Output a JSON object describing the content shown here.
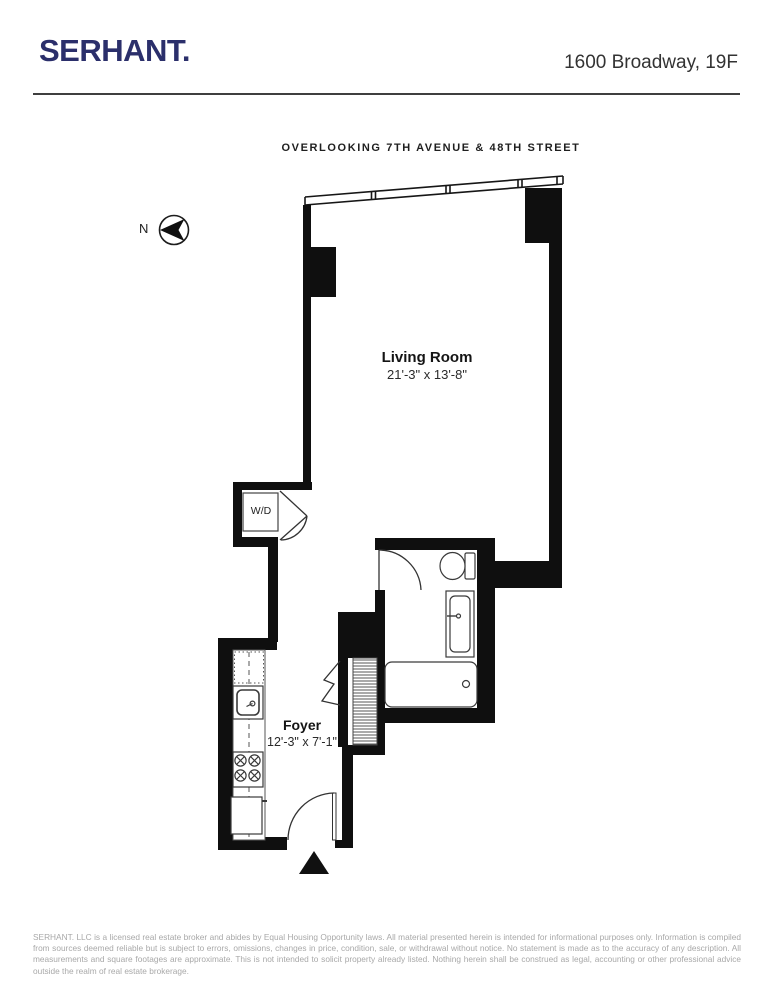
{
  "header": {
    "brand": "SERHANT.",
    "address": "1600 Broadway, 19F"
  },
  "plan": {
    "orientation_note": "OVERLOOKING 7TH AVENUE & 48TH STREET",
    "compass_label": "N",
    "rooms": [
      {
        "name": "Living Room",
        "dimensions": "21'-3\" x 13'-8\""
      },
      {
        "name": "Foyer",
        "dimensions": "12'-3\" x 7'-1\""
      }
    ],
    "fixtures": {
      "washer_dryer": "W/D"
    }
  },
  "footer": {
    "disclaimer": "SERHANT. LLC is a licensed real estate broker and abides by Equal Housing Opportunity laws. All material presented herein is intended for informational purposes only. Information is compiled from sources deemed reliable but is subject to errors, omissions, changes in price, condition, sale, or withdrawal without notice. No statement is made as to the accuracy of any description. All measurements and square footages are approximate. This is not intended to solicit property already listed. Nothing herein shall be construed as legal, accounting or other professional advice outside the realm of real estate brokerage."
  },
  "colors": {
    "brand_navy": "#2b2f6b",
    "wall_black": "#0f0f0f"
  }
}
